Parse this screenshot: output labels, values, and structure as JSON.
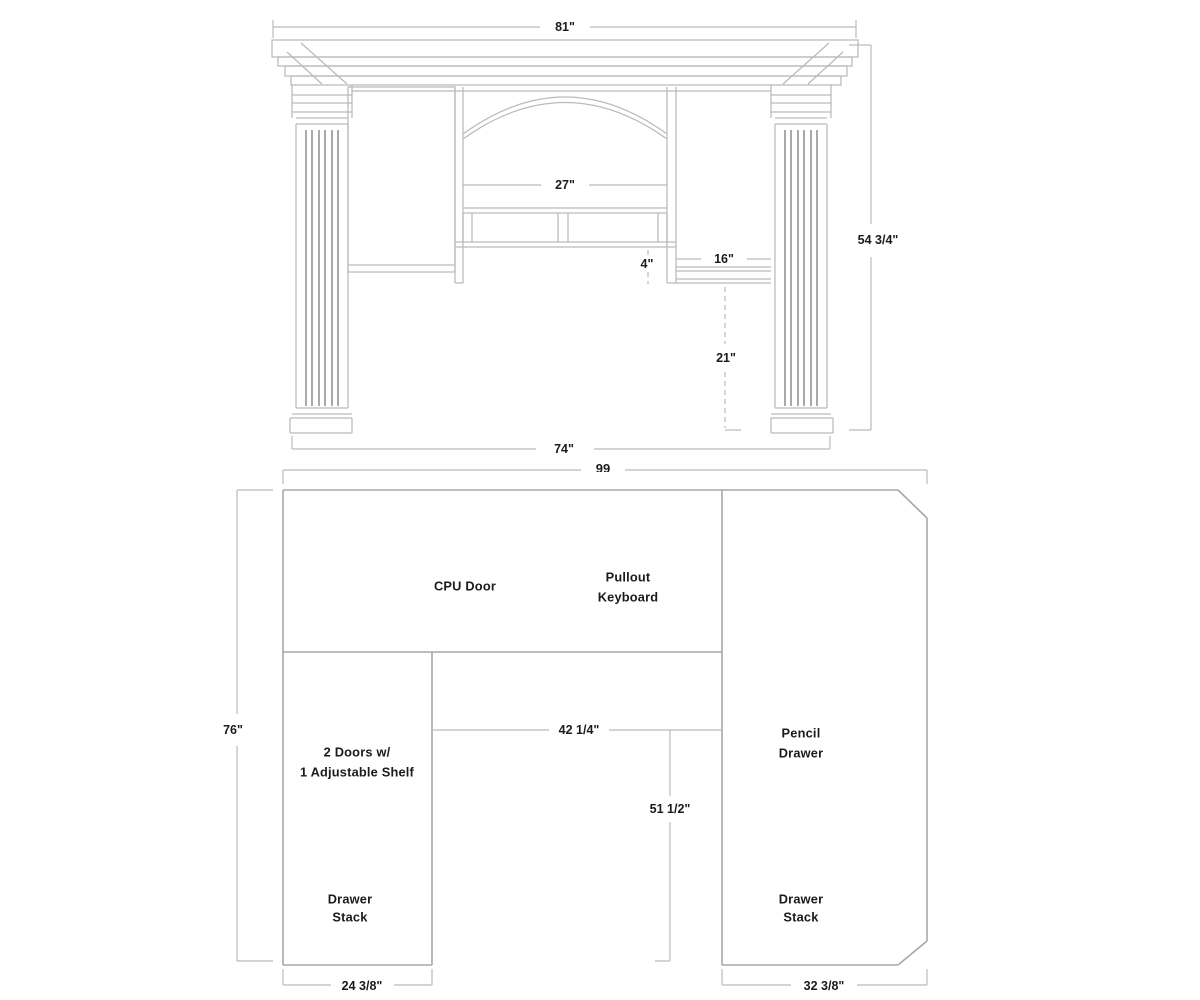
{
  "colors": {
    "line": "#b7bbbd",
    "main_outline": "#a3a8ab",
    "flute": "#6e7173",
    "text": "#1b1b1b",
    "background": "#ffffff"
  },
  "hutch": {
    "dims": {
      "crown_width": "81\"",
      "center_opening_width": "27\"",
      "shelf_clearance": "4\"",
      "right_cubby_width": "16\"",
      "under_shelf_height": "21\"",
      "overall_height": "54 3/4\"",
      "body_width": "74\""
    }
  },
  "desk": {
    "dims": {
      "overall_width": "99",
      "overall_depth": "76\"",
      "kneehole_width": "42 1/4\"",
      "pedestal_depth": "51 1/2\"",
      "left_pedestal_width": "24 3/8\"",
      "right_pedestal_width": "32 3/8\""
    },
    "labels": {
      "cpu_door": "CPU Door",
      "pullout_keyboard_1": "Pullout",
      "pullout_keyboard_2": "Keyboard",
      "left_cabinet_1": "2 Doors w/",
      "left_cabinet_2": "1 Adjustable Shelf",
      "left_drawer_1": "Drawer",
      "left_drawer_2": "Stack",
      "pencil_drawer_1": "Pencil",
      "pencil_drawer_2": "Drawer",
      "right_drawer_1": "Drawer",
      "right_drawer_2": "Stack"
    }
  }
}
